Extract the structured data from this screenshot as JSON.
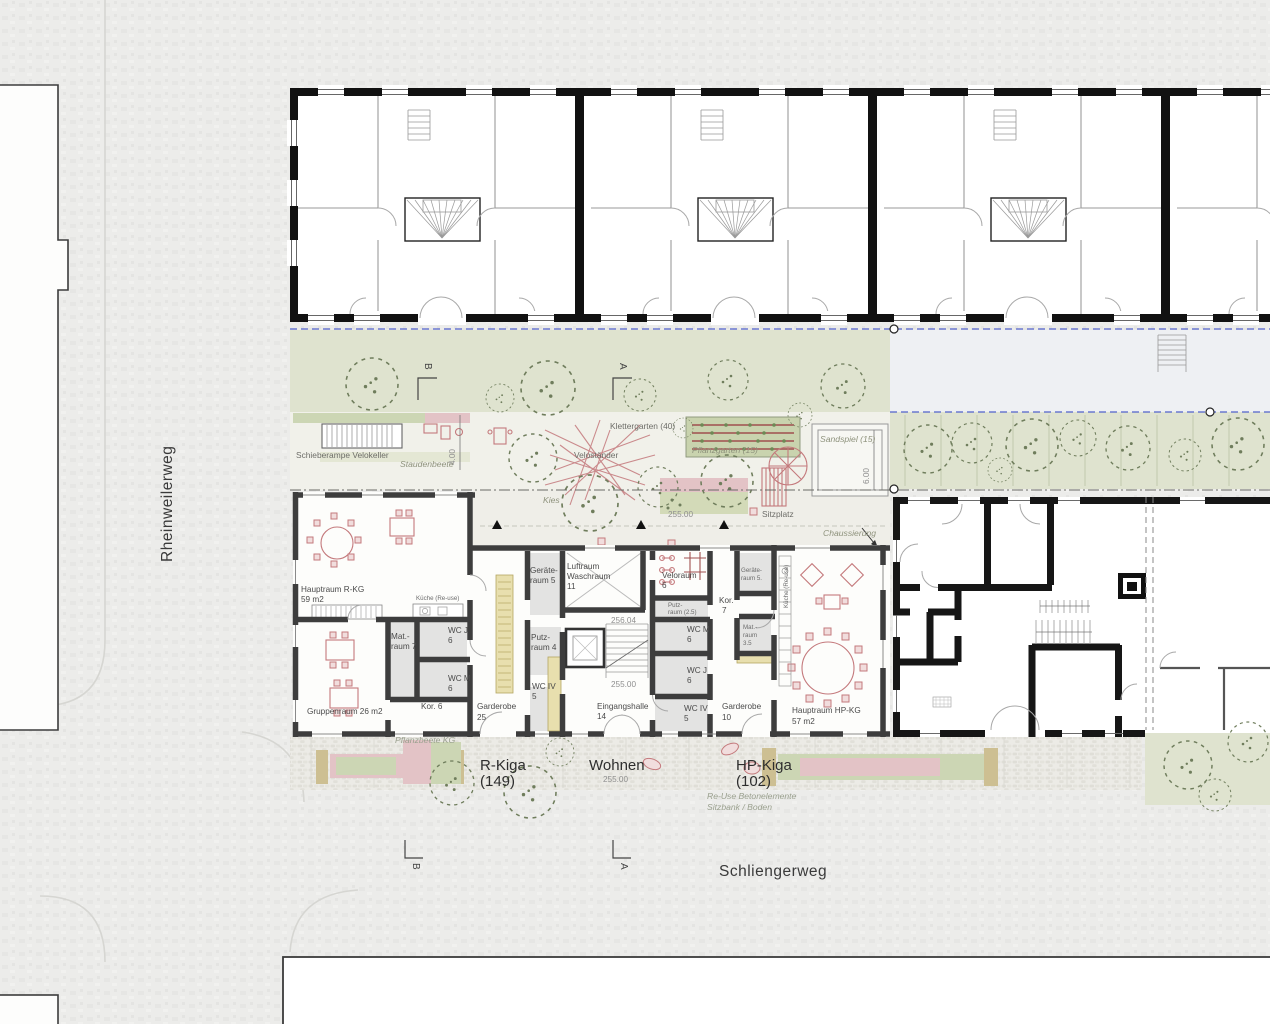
{
  "streets": {
    "left": "Rheinweilerweg",
    "bottom": "Schliengerweg"
  },
  "site": {
    "schieberampe": "Schieberampe Velokeller",
    "staudenbeete": "Staudenbeete",
    "velostaender": "Veloständer",
    "klettergarten": "Klettergarten (40)",
    "pflanzgarten": "Pflanzgarten (15)",
    "sandspiel": "Sandspiel (15)",
    "kies": "Kies",
    "sitzplatz": "Sitzplatz",
    "chaussierung": "Chaussierung",
    "pflanzbeete": "Pflanzbeete KG",
    "dim_ramp": "4.00",
    "dim_sand": "6.00",
    "level_court": "255.00"
  },
  "rkiga": {
    "hauptraum_name": "Hauptraum R-KG",
    "hauptraum_area": "59 m2",
    "kueche": "Küche (Re-use)",
    "mat_1": "Mat.-",
    "mat_2": "raum 7",
    "wcj_1": "WC J",
    "wcj_2": "6",
    "wcm_1": "WC M",
    "wcm_2": "6",
    "gruppenraum": "Gruppenraum 26  m2",
    "kor": "Kor. 6",
    "garderobe_1": "Garderobe",
    "garderobe_2": "25"
  },
  "core": {
    "geraete_1": "Geräte-",
    "geraete_2": "raum 5",
    "luftraum_1": "Luftraum",
    "luftraum_2": "Waschraum",
    "luftraum_3": "11",
    "level_upper": "256.04",
    "putz_1": "Putz-",
    "putz_2": "raum 4",
    "wciv_1": "WC IV",
    "wciv_2": "5",
    "level_hall": "255.00",
    "eingangshalle_1": "Eingangshalle",
    "eingangshalle_2": "14"
  },
  "hpkiga": {
    "veloraum_1": "Veloraum",
    "veloraum_2": "6",
    "putz_1": "Putz-",
    "putz_2": "raum (2.5)",
    "wcm_1": "WC M",
    "wcm_2": "6",
    "wcj_1": "WC J",
    "wcj_2": "6",
    "wciv_1": "WC IV",
    "wciv_2": "5",
    "kor_1": "Kor.",
    "kor_2": "7",
    "geraete_1": "Geräte-",
    "geraete_2": "raum 5.",
    "mat_1": "Mat.-",
    "mat_2": "raum",
    "mat_3": "3.5",
    "garderobe_1": "Garderobe",
    "garderobe_2": "10",
    "hauptraum_name": "Hauptraum HP-KG",
    "hauptraum_area": "57 m2",
    "kueche": "Küche (Re-use)"
  },
  "entrances": {
    "rkiga_1": "R-Kiga",
    "rkiga_2": "(149)",
    "wohnen": "Wohnen",
    "wohnen_level": "255.00",
    "hpkiga_1": "HP-Kiga",
    "hpkiga_2": "(102)"
  },
  "notes": {
    "reuse_1": "Re-Use Betonelemente",
    "reuse_2": "Sitzbank / Boden"
  },
  "sections": {
    "a": "A",
    "b": "B"
  },
  "colors": {
    "green": "#dfe3cf",
    "green_dark": "#c9d3ae",
    "pink": "#e3c3c6",
    "accent_pink": "#c4797c",
    "wall_dark": "#161616",
    "wall_gray": "#3d3d3d",
    "blue_dashed": "#5262cc",
    "bench_tan": "#e8dfae"
  }
}
